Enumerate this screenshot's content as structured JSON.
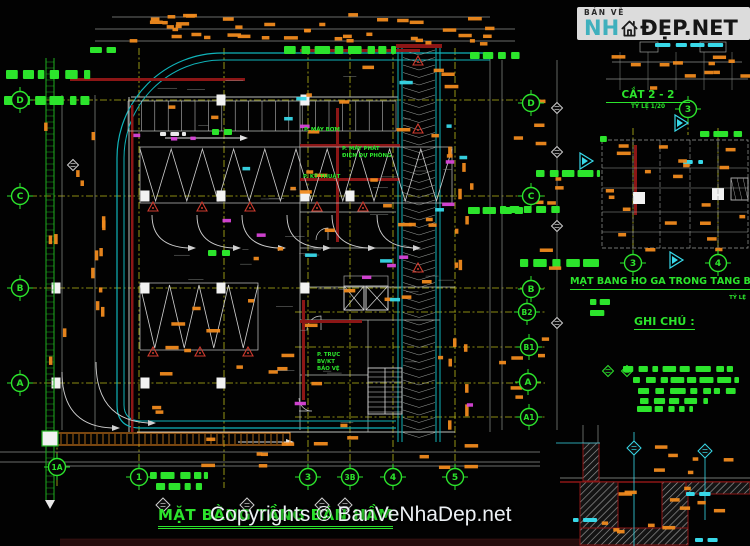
{
  "brand": {
    "tagline": "BẢN VẼ",
    "name_left": "NH",
    "name_right": "ĐẸP.NET",
    "icon": "house-icon",
    "teal_color": "#3fb0bd",
    "copyright": "Copyrights © BanVeNhaDep.net"
  },
  "titles": {
    "main": {
      "text": "MẶT BẰNG TẦNG BÁN HẦM"
    },
    "section": {
      "text": "CẮT 2 - 2",
      "scale": "TỶ LỆ 1/20"
    },
    "manhole": {
      "text": "MẶT BẰNG HỐ GA TRONG TẦNG BÁN HẦM",
      "scale": "TỶ LỆ"
    },
    "notes_heading": "GHI CHÚ :"
  },
  "rooms": [
    {
      "lines": [
        "P. MÁY BƠM"
      ],
      "x": 304,
      "y": 131
    },
    {
      "lines": [
        "P. MÁY PHÁT",
        "ĐIỆN DỰ PHÒNG"
      ],
      "x": 342,
      "y": 150
    },
    {
      "lines": [
        "P. KỸ THUẬT"
      ],
      "x": 303,
      "y": 178
    },
    {
      "lines": [
        "P. TRỰC",
        "BV/KT",
        "BẢO VỆ"
      ],
      "x": 317,
      "y": 356
    }
  ],
  "grid_bubbles": [
    {
      "label": "D",
      "x": 20,
      "y": 100
    },
    {
      "label": "C",
      "x": 20,
      "y": 196
    },
    {
      "label": "B",
      "x": 20,
      "y": 288
    },
    {
      "label": "A",
      "x": 20,
      "y": 383
    },
    {
      "label": "1A",
      "x": 57,
      "y": 467
    },
    {
      "label": "1",
      "x": 139,
      "y": 477
    },
    {
      "label": "3",
      "x": 308,
      "y": 477
    },
    {
      "label": "3B",
      "x": 350,
      "y": 477
    },
    {
      "label": "4",
      "x": 393,
      "y": 477
    },
    {
      "label": "5",
      "x": 455,
      "y": 477
    },
    {
      "label": "D",
      "x": 531,
      "y": 103
    },
    {
      "label": "C",
      "x": 531,
      "y": 196
    },
    {
      "label": "B",
      "x": 531,
      "y": 289
    },
    {
      "label": "B2",
      "x": 527,
      "y": 312
    },
    {
      "label": "B1",
      "x": 529,
      "y": 347
    },
    {
      "label": "A",
      "x": 528,
      "y": 382
    },
    {
      "label": "A1",
      "x": 529,
      "y": 417
    },
    {
      "label": "3",
      "x": 688,
      "y": 109
    },
    {
      "label": "3",
      "x": 633,
      "y": 263
    },
    {
      "label": "4",
      "x": 718,
      "y": 263
    }
  ],
  "colors": {
    "green": "#2ce42c",
    "green_wall": "#1fae1f",
    "orange": "#f08a1e",
    "yellow_grid": "#b9b919",
    "teal": "#10b4ba",
    "cyan": "#38d8e8",
    "magenta": "#d844d8",
    "maroon": "#8c1616",
    "red_marker": "#cf3b2e",
    "line_gray": "#b9bdb9",
    "dim_gray": "#8d918d",
    "white": "#e9e9e9"
  }
}
